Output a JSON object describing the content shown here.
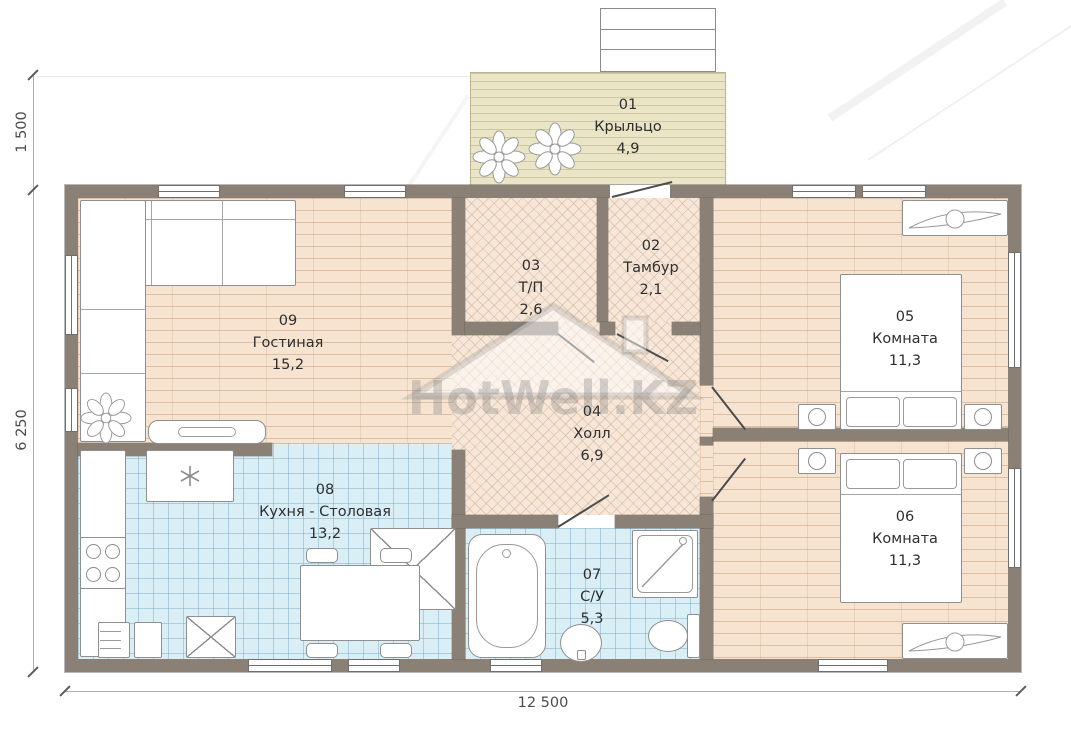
{
  "watermark": {
    "text": "HotWell.KZ"
  },
  "plan": {
    "rooms": [
      {
        "id": "01",
        "name": "Крыльцо",
        "area": "4,9"
      },
      {
        "id": "02",
        "name": "Тамбур",
        "area": "2,1"
      },
      {
        "id": "03",
        "name": "Т/П",
        "area": "2,6"
      },
      {
        "id": "04",
        "name": "Холл",
        "area": "6,9"
      },
      {
        "id": "05",
        "name": "Комната",
        "area": "11,3"
      },
      {
        "id": "06",
        "name": "Комната",
        "area": "11,3"
      },
      {
        "id": "07",
        "name": "С/У",
        "area": "5,3"
      },
      {
        "id": "08",
        "name": "Кухня - Столовая",
        "area": "13,2"
      },
      {
        "id": "09",
        "name": "Гостиная",
        "area": "15,2"
      }
    ],
    "dimensions": {
      "top_left_vertical": "1 500",
      "left_vertical": "6 250",
      "bottom_horizontal": "12 500"
    },
    "colors": {
      "wall": "#8a8076",
      "porch_floor": "#e9e5c6",
      "plank_floor": "#f7e4d0",
      "herringbone_floor": "#f6e7d8",
      "tile_floor": "#daeef6"
    }
  }
}
